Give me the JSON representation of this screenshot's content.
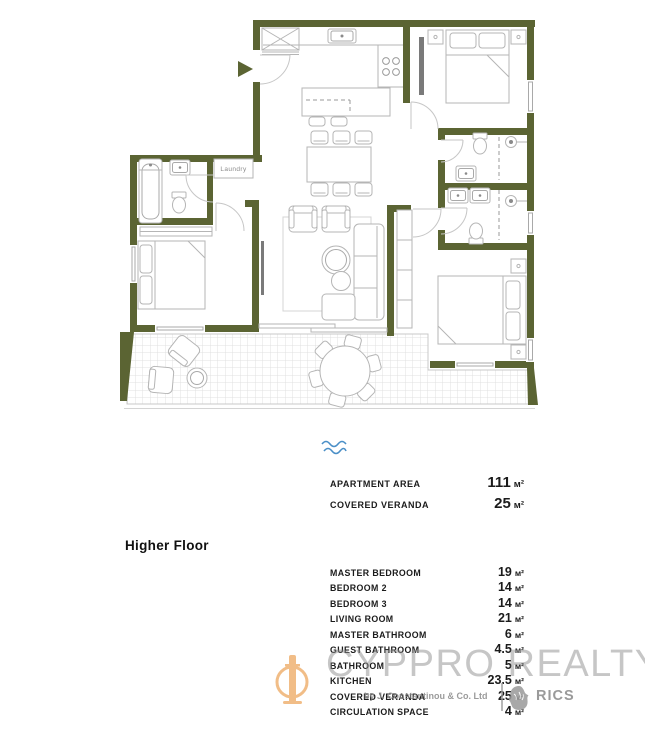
{
  "plan": {
    "floor_label": "Higher Floor",
    "laundry_label": "Laundry",
    "wall_color": "#5b6433",
    "furniture_line_color": "#b5b5b5",
    "veranda_grid_color": "#e0e0e0",
    "wave_icon_color": "#4a8fc7"
  },
  "summary": {
    "rows": [
      {
        "label": "APARTMENT AREA",
        "value": "111",
        "unit": "м²"
      },
      {
        "label": "COVERED VERANDA",
        "value": "25",
        "unit": "м²"
      }
    ]
  },
  "details": {
    "rows": [
      {
        "label": "MASTER BEDROOM",
        "value": "19",
        "unit": "м²"
      },
      {
        "label": "BEDROOM 2",
        "value": "14",
        "unit": "м²"
      },
      {
        "label": "BEDROOM 3",
        "value": "14",
        "unit": "м²"
      },
      {
        "label": "LIVING ROOM",
        "value": "21",
        "unit": "м²"
      },
      {
        "label": "MASTER BATHROOM",
        "value": "6",
        "unit": "м²"
      },
      {
        "label": "GUEST BATHROOM",
        "value": "4.5",
        "unit": "м²"
      },
      {
        "label": "BATHROOM",
        "value": "5",
        "unit": "м²"
      },
      {
        "label": "KITCHEN",
        "value": "23.5",
        "unit": "м²"
      },
      {
        "label": "COVERED VERANDA",
        "value": "25",
        "unit": "м²"
      },
      {
        "label": "CIRCULATION SPACE",
        "value": "4",
        "unit": "м²"
      }
    ]
  },
  "watermark": {
    "brand": "CYPPRO REALTY",
    "byline": "by J. Constantinou & Co. Ltd",
    "rics_label": "RICS",
    "logo_color": "#eda75f"
  }
}
